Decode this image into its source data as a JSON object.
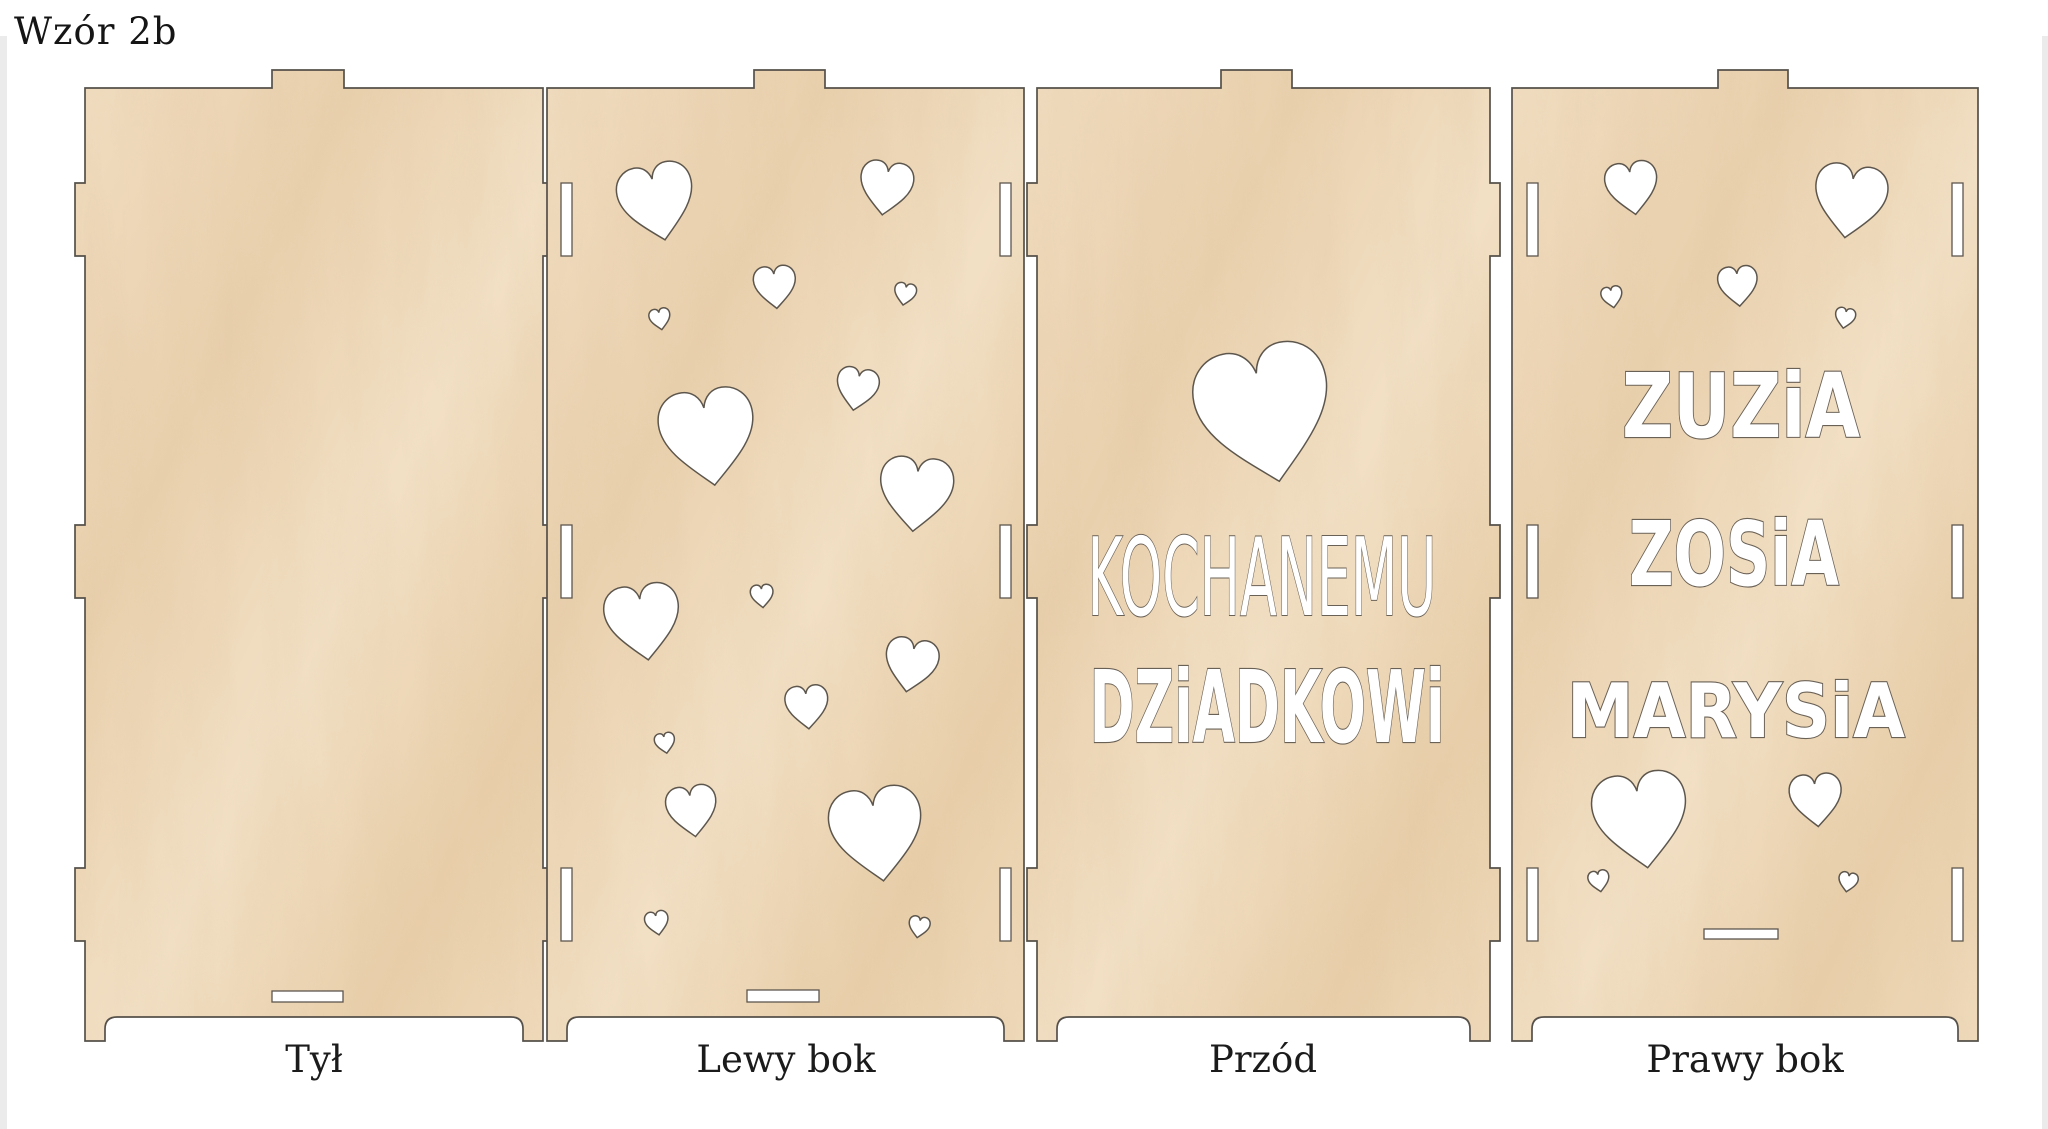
{
  "title": "Wzór 2b",
  "colors": {
    "background": "#ffffff",
    "wood_light": "#f2e0c5",
    "wood_mid": "#ead0ac",
    "wood_dark": "#e0c199",
    "outline": "#55504a",
    "cutout_fill": "#ffffff",
    "label_text": "#1b1b1b"
  },
  "panels": [
    {
      "label": "Tył",
      "texts": [],
      "hearts": [],
      "slots": [
        {
          "x": 197,
          "y": 921,
          "w": 71,
          "h": 11
        }
      ]
    },
    {
      "label": "Lewy bok",
      "texts": [],
      "hearts": [
        {
          "x": 110,
          "y": 132,
          "s": 0.9,
          "rot": -12
        },
        {
          "x": 339,
          "y": 118,
          "s": 0.63,
          "rot": 8
        },
        {
          "x": 228,
          "y": 217,
          "s": 0.5,
          "rot": -5
        },
        {
          "x": 358,
          "y": 224,
          "s": 0.26,
          "rot": 10
        },
        {
          "x": 113,
          "y": 249,
          "s": 0.25,
          "rot": -10
        },
        {
          "x": 310,
          "y": 319,
          "s": 0.5,
          "rot": 10
        },
        {
          "x": 161,
          "y": 367,
          "s": 1.13,
          "rot": -8
        },
        {
          "x": 369,
          "y": 424,
          "s": 0.87,
          "rot": 5
        },
        {
          "x": 96,
          "y": 552,
          "s": 0.89,
          "rot": -8
        },
        {
          "x": 215,
          "y": 526,
          "s": 0.27,
          "rot": -5
        },
        {
          "x": 364,
          "y": 595,
          "s": 0.63,
          "rot": 10
        },
        {
          "x": 260,
          "y": 637,
          "s": 0.51,
          "rot": -5
        },
        {
          "x": 118,
          "y": 673,
          "s": 0.24,
          "rot": -10
        },
        {
          "x": 145,
          "y": 741,
          "s": 0.6,
          "rot": -8
        },
        {
          "x": 330,
          "y": 764,
          "s": 1.1,
          "rot": -8
        },
        {
          "x": 110,
          "y": 853,
          "s": 0.28,
          "rot": -10
        },
        {
          "x": 372,
          "y": 857,
          "s": 0.25,
          "rot": 10
        }
      ],
      "slots": [
        {
          "x": 14,
          "y": 113,
          "w": 11,
          "h": 73
        },
        {
          "x": 453,
          "y": 113,
          "w": 11,
          "h": 73
        },
        {
          "x": 14,
          "y": 455,
          "w": 11,
          "h": 73
        },
        {
          "x": 453,
          "y": 455,
          "w": 11,
          "h": 73
        },
        {
          "x": 14,
          "y": 798,
          "w": 11,
          "h": 73
        },
        {
          "x": 453,
          "y": 798,
          "w": 11,
          "h": 73
        },
        {
          "x": 200,
          "y": 920,
          "w": 72,
          "h": 12
        }
      ]
    },
    {
      "label": "Przód",
      "texts": [
        "KOCHANEMU",
        "DZiADKOWi"
      ],
      "hearts": [
        {
          "x": 238,
          "y": 344,
          "s": 1.6,
          "rot": -12
        }
      ],
      "slots": []
    },
    {
      "label": "Prawy bok",
      "texts": [
        "ZUZiA",
        "ZOSiA",
        "MARYSiA"
      ],
      "hearts": [
        {
          "x": 120,
          "y": 118,
          "s": 0.62,
          "rot": -8
        },
        {
          "x": 338,
          "y": 131,
          "s": 0.86,
          "rot": 8
        },
        {
          "x": 226,
          "y": 216,
          "s": 0.47,
          "rot": -5
        },
        {
          "x": 100,
          "y": 227,
          "s": 0.25,
          "rot": -10
        },
        {
          "x": 333,
          "y": 248,
          "s": 0.24,
          "rot": 10
        },
        {
          "x": 129,
          "y": 750,
          "s": 1.12,
          "rot": -8
        },
        {
          "x": 304,
          "y": 730,
          "s": 0.62,
          "rot": -5
        },
        {
          "x": 87,
          "y": 811,
          "s": 0.25,
          "rot": -10
        },
        {
          "x": 336,
          "y": 812,
          "s": 0.23,
          "rot": 10
        }
      ],
      "slots": [
        {
          "x": 15,
          "y": 113,
          "w": 11,
          "h": 73
        },
        {
          "x": 440,
          "y": 113,
          "w": 11,
          "h": 73
        },
        {
          "x": 15,
          "y": 455,
          "w": 11,
          "h": 73
        },
        {
          "x": 440,
          "y": 455,
          "w": 11,
          "h": 73
        },
        {
          "x": 15,
          "y": 798,
          "w": 11,
          "h": 73
        },
        {
          "x": 440,
          "y": 798,
          "w": 11,
          "h": 73
        },
        {
          "x": 192,
          "y": 859,
          "w": 74,
          "h": 10
        }
      ]
    }
  ]
}
